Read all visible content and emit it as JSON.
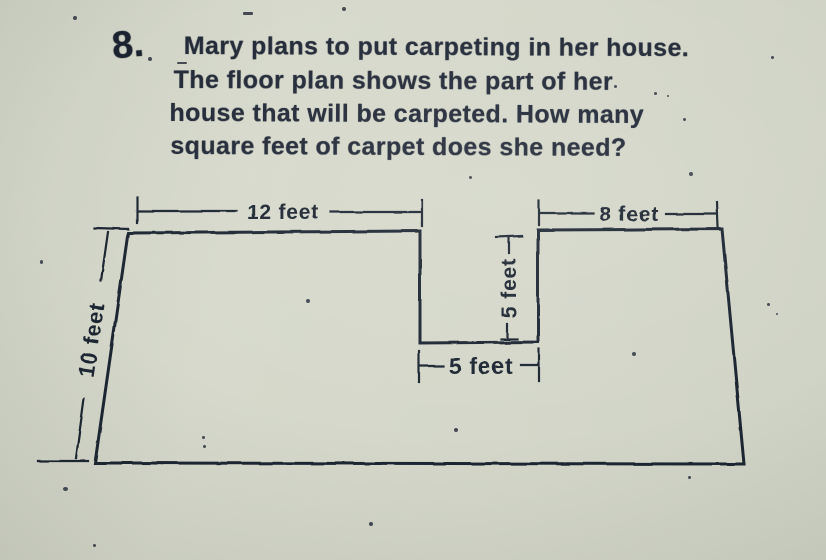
{
  "colors": {
    "paper": "#d3d6c8",
    "ink": "#1f2633"
  },
  "problem": {
    "number": "8.",
    "lines": [
      "Mary plans to put carpeting in her house.",
      "The floor plan shows the part of her",
      "house that will be carpeted. How many",
      "square feet of carpet does she need?"
    ]
  },
  "diagram": {
    "type": "floor-plan",
    "shape": "rectangle with rectangular notch cut from top middle",
    "labels": {
      "top_left_width": "12 feet",
      "top_right_width": "8 feet",
      "left_height": "10 feet",
      "notch_depth": "5 feet",
      "notch_width": "5 feet"
    }
  }
}
